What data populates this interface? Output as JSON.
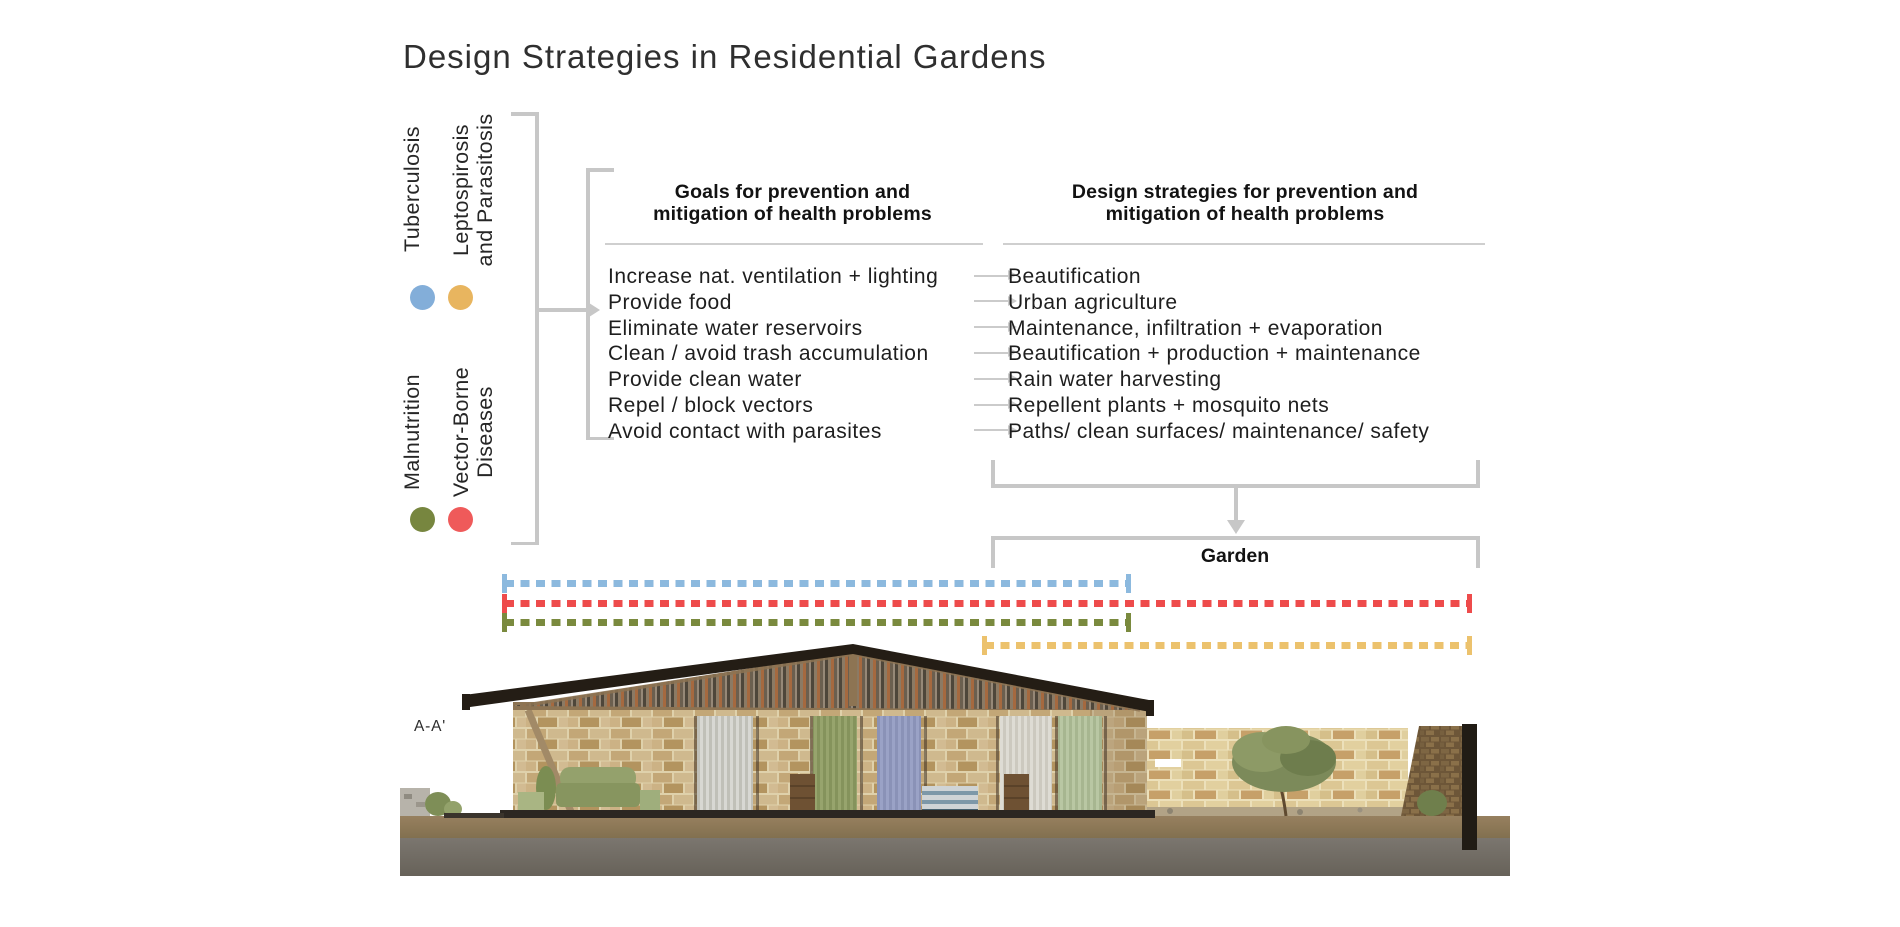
{
  "title": "Design Strategies in Residential Gardens",
  "legend": {
    "tuberculosis": "Tuberculosis",
    "leptospirosis_line1": "Leptospirosis",
    "leptospirosis_line2": "and Parasitosis",
    "malnutrition": "Malnutrition",
    "vector_line1": "Vector-Borne",
    "vector_line2": "Diseases",
    "colors": {
      "tuberculosis": "#83aed9",
      "leptospirosis_parasitosis": "#e8b55f",
      "malnutrition": "#77863f",
      "vector_borne": "#ef5a5a"
    }
  },
  "goals": {
    "header_line1": "Goals for prevention and",
    "header_line2": "mitigation of health problems",
    "items": [
      "Increase nat. ventilation + lighting",
      "Provide food",
      "Eliminate water reservoirs",
      "Clean / avoid trash accumulation",
      "Provide clean water",
      "Repel / block vectors",
      "Avoid contact with parasites"
    ]
  },
  "strategies": {
    "header_line1": "Design strategies for prevention and",
    "header_line2": "mitigation of health problems",
    "items": [
      "Beautification",
      "Urban agriculture",
      "Maintenance, infiltration + evaporation",
      "Beautification + production + maintenance",
      "Rain water harvesting",
      "Repellent plants + mosquito nets",
      "Paths/ clean surfaces/ maintenance/ safety"
    ]
  },
  "garden": {
    "label": "Garden"
  },
  "section": {
    "label": "A-A'"
  },
  "spans": {
    "blue": {
      "color": "#8cb9de"
    },
    "red": {
      "color": "#ee4b4b"
    },
    "green": {
      "color": "#7a8a3e"
    },
    "yellow": {
      "color": "#ecc26d"
    }
  }
}
